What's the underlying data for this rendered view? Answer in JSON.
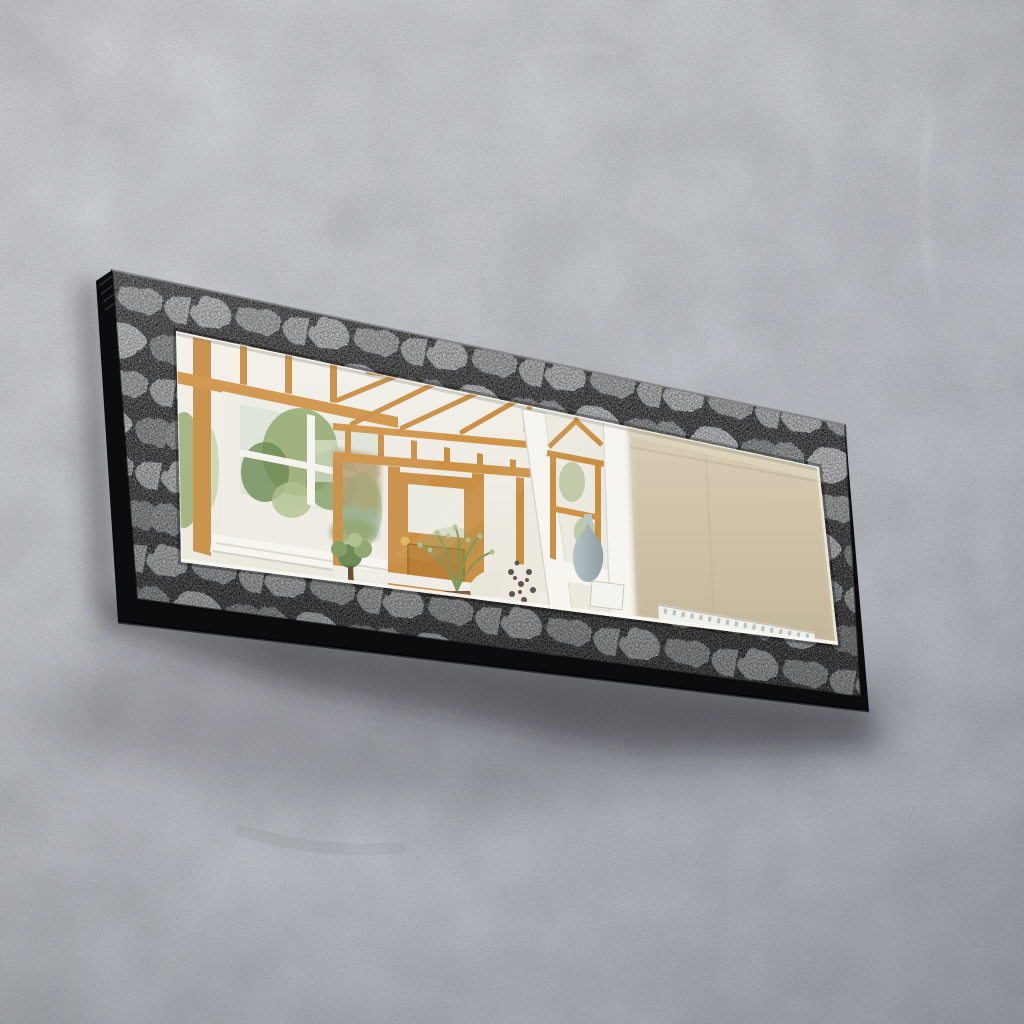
{
  "meta": {
    "title": "Decorative wall mirror with grey stone-print frame",
    "alt": "A rectangular wall mirror in a grey stone print frame hangs at a slight angle on a bare grey concrete wall. The bevelled mirror reflects a conservatory interior: golden oak framed windows and doors, a white sash window with greenery, roof rafters, potted plants, a cream sofa with a floral cushion, a grey-blue vase beside an open white door, and a plain beige wall with a white radiator."
  },
  "palette": {
    "wall_top": "#d1d4d8",
    "wall_mid": "#bec2c8",
    "wall_bottom": "#a9afb7",
    "shadow": "#1c1e24",
    "frame_side": "#0c0c0e",
    "stone_joint": "#161617",
    "stone_light": "#aeb0b2",
    "stone_mid": "#8b8d8f",
    "stone_dark": "#6f7173",
    "mirror_top": "#f4f2ea",
    "mirror_bottom": "#e8e5da",
    "bevel": "#f8f7f0",
    "oak": "#c88f45",
    "oak_dark": "#9a6826",
    "oak_light": "#e9b769",
    "white_frame": "#efede5",
    "white_bright": "#f6f5f0",
    "foliage": "#8ea468",
    "foliage_dark": "#67844d",
    "foliage_light": "#aebf8a",
    "thatch": "#b4a076",
    "cottage_wall": "#9fb4ae",
    "beige_top": "#d8cdb5",
    "beige_bottom": "#c3b69a",
    "vase_light": "#b9c4c6",
    "vase_dark": "#8d9da1",
    "pot": "#8a6a4e",
    "trunk": "#6b4e33",
    "sofa": "#e9e5d9",
    "cushion": "#ece8de",
    "floral": "#5d5350",
    "radiator": "#eef0ec",
    "knob": "#dfb55c"
  },
  "scene": {
    "wall": "bare grey concrete wall",
    "frame": "grey stone print frame with black slab edges",
    "mirror": "bevelled rectangular mirror",
    "reflection_left": "white sash window with greenery inside a golden oak conservatory wall",
    "reflection_center": "golden oak glazed doors with roof rafters, thatched cottage outside, potted plants, cream sofa with floral cushion",
    "reflection_right": "open white door, oak window with grey-blue vase, beige wall with white radiator"
  }
}
